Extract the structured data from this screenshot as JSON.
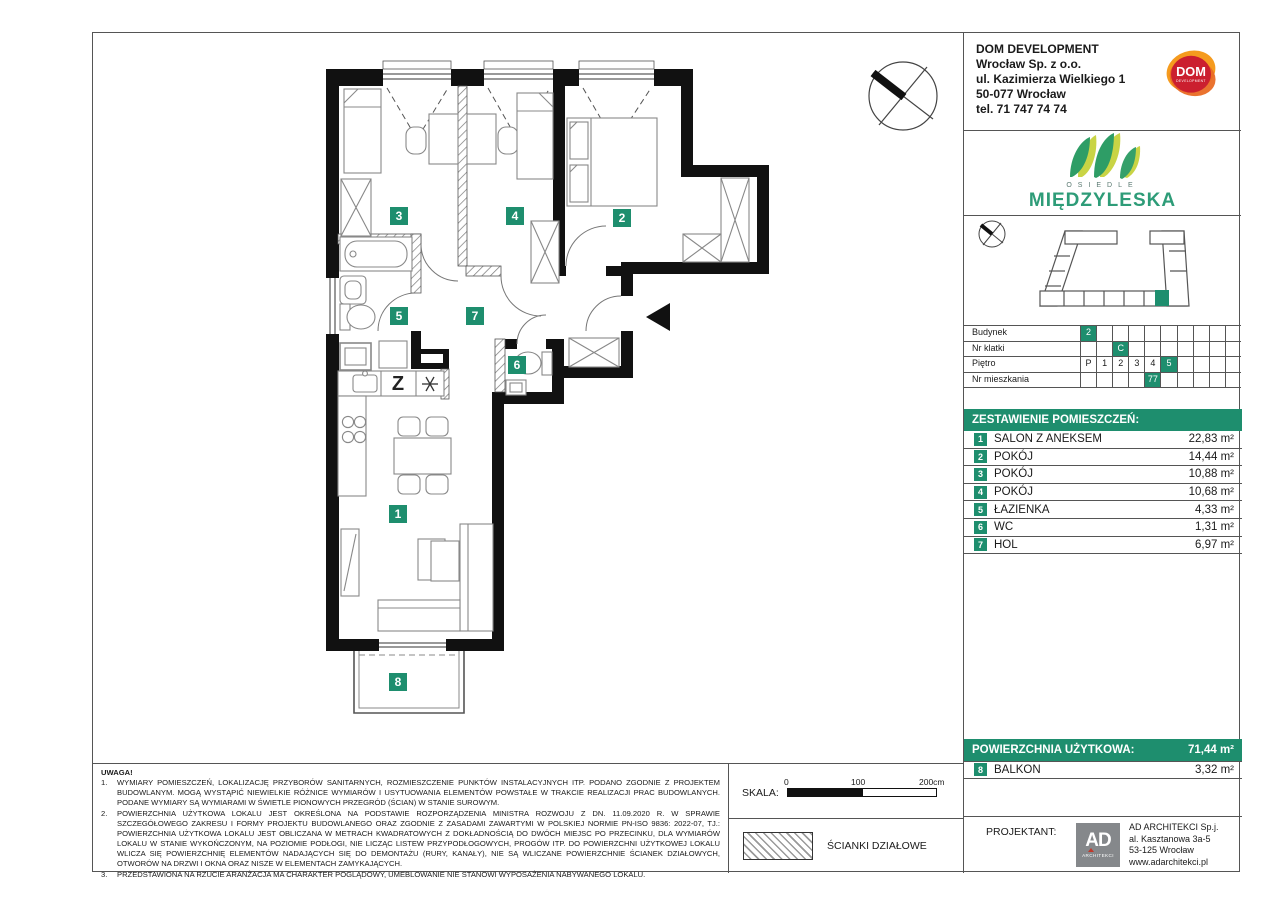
{
  "company": {
    "name": "DOM DEVELOPMENT",
    "lines": [
      "Wrocław Sp. z o.o.",
      "ul. Kazimierza Wielkiego 1",
      "50-077 Wrocław",
      "tel. 71 747 74 74"
    ],
    "logo_top": "DOM",
    "logo_sub": "DEVELOPMENT"
  },
  "estate_logo": {
    "top": "OSIEDLE",
    "name": "MIĘDZYLESKA"
  },
  "unit_info": {
    "rows": [
      {
        "label": "Budynek",
        "cells": [
          "2",
          "",
          "",
          "",
          "",
          "",
          "",
          "",
          "",
          ""
        ],
        "highlight": [
          0
        ]
      },
      {
        "label": "Nr klatki",
        "cells": [
          "",
          "",
          "C",
          "",
          "",
          "",
          "",
          "",
          "",
          ""
        ],
        "highlight": [
          2
        ]
      },
      {
        "label": "Piętro",
        "cells": [
          "P",
          "1",
          "2",
          "3",
          "4",
          "5",
          "",
          "",
          "",
          ""
        ],
        "highlight": [
          5
        ]
      },
      {
        "label": "Nr mieszkania",
        "cells": [
          "",
          "",
          "",
          "",
          "77",
          "",
          "",
          "",
          "",
          ""
        ],
        "highlight": [
          4
        ]
      }
    ]
  },
  "rooms": {
    "header": "ZESTAWIENIE POMIESZCZEŃ:",
    "items": [
      {
        "no": "1",
        "name": "SALON Z ANEKSEM",
        "area": "22,83 m²"
      },
      {
        "no": "2",
        "name": "POKÓJ",
        "area": "14,44 m²"
      },
      {
        "no": "3",
        "name": "POKÓJ",
        "area": "10,88 m²"
      },
      {
        "no": "4",
        "name": "POKÓJ",
        "area": "10,68 m²"
      },
      {
        "no": "5",
        "name": "ŁAZIENKA",
        "area": "4,33 m²"
      },
      {
        "no": "6",
        "name": "WC",
        "area": "1,31 m²"
      },
      {
        "no": "7",
        "name": "HOL",
        "area": "6,97 m²"
      }
    ]
  },
  "totals": {
    "label": "POWIERZCHNIA UŻYTKOWA:",
    "value": "71,44 m²",
    "balcony": {
      "no": "8",
      "name": "BALKON",
      "area": "3,32 m²"
    }
  },
  "notes": {
    "title": "UWAGA!",
    "items": [
      "WYMIARY POMIESZCZEŃ, LOKALIZACJĘ PRZYBORÓW SANITARNYCH, ROZMIESZCZENIE PUNKTÓW INSTALACYJNYCH ITP. PODANO ZGODNIE Z PROJEKTEM BUDOWLANYM. MOGĄ WYSTĄPIĆ NIEWIELKIE RÓŻNICE WYMIARÓW I USYTUOWANIA ELEMENTÓW POWSTAŁE W TRAKCIE REALIZACJI PRAC BUDOWLANYCH. PODANE WYMIARY SĄ WYMIARAMI W ŚWIETLE PIONOWYCH PRZEGRÓD (ŚCIAN) W STANIE SUROWYM.",
      "POWIERZCHNIA UŻYTKOWA LOKALU JEST OKREŚLONA NA PODSTAWIE ROZPORZĄDZENIA MINISTRA ROZWOJU Z DN. 11.09.2020 R. W SPRAWIE SZCZEGÓŁOWEGO ZAKRESU I FORMY PROJEKTU BUDOWLANEGO ORAZ ZGODNIE Z ZASADAMI ZAWARTYMI W POLSKIEJ NORMIE PN-ISO 9836: 2022-07, TJ.: POWIERZCHNIA UŻYTKOWA LOKALU JEST OBLICZANA W METRACH KWADRATOWYCH Z DOKŁADNOŚCIĄ DO DWÓCH MIEJSC PO PRZECINKU, DLA WYMIARÓW LOKALU W STANIE WYKOŃCZONYM, NA POZIOMIE PODŁOGI, NIE LICZĄC LISTEW PRZYPODŁOGOWYCH, PROGÓW ITP. DO POWIERZCHNI UŻYTKOWEJ LOKALU WLICZA SIĘ POWIERZCHNIĘ ELEMENTÓW NADAJĄCYCH SIĘ DO DEMONTAŻU (RURY, KANAŁY), NIE SĄ WLICZANE POWIERZCHNIE ŚCIANEK DZIAŁOWYCH, OTWORÓW NA DRZWI I OKNA ORAZ NISZE W ELEMENTACH ZAMYKAJĄCYCH.",
      "PRZEDSTAWIONA NA RZUCIE ARANŻACJA MA CHARAKTER POGLĄDOWY, UMEBLOWANIE NIE STANOWI WYPOSAŻENIA NABYWANEGO LOKALU."
    ]
  },
  "scale": {
    "label": "SKALA:",
    "tick0": "0",
    "tick100": "100",
    "tick200": "200cm"
  },
  "legend": {
    "partition_walls": "ŚCIANKI DZIAŁOWE"
  },
  "designer": {
    "label": "PROJEKTANT:",
    "logo_big": "AD",
    "logo_sub": "ARCHITEKCI",
    "lines": [
      "AD ARCHITEKCI Sp.j.",
      "al. Kasztanowa 3a-5",
      "53-125 Wrocław",
      "www.adarchitekci.pl"
    ]
  },
  "plan": {
    "labels": [
      "1",
      "2",
      "3",
      "4",
      "5",
      "6",
      "7",
      "8"
    ],
    "kitchen_symbol": "Z",
    "accent_color": "#1e8e6e"
  }
}
